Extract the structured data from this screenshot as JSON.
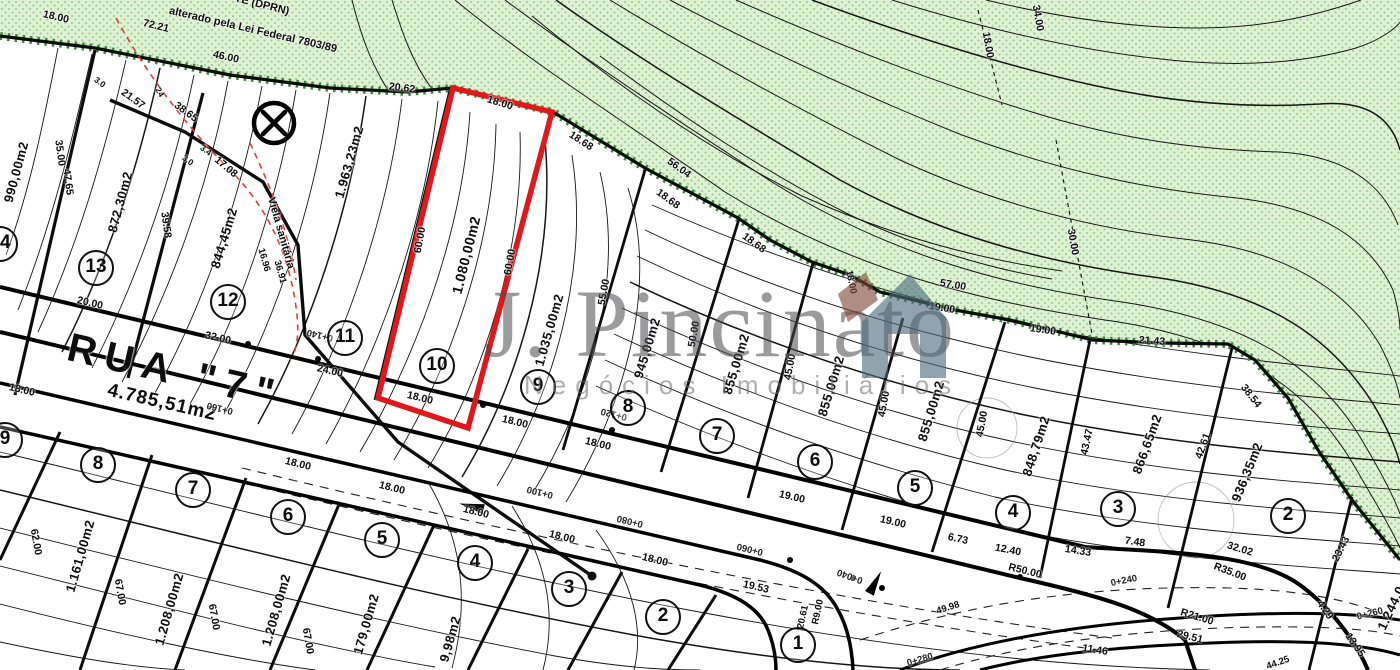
{
  "map": {
    "colors": {
      "lot_highlight_red": "#e0181c",
      "vegetation_fill": "#def1d2",
      "vegetation_dot": "#90cb90",
      "boundary_hatch_green": "#3a8a3a",
      "contour_black": "#161616",
      "red_dashed_line": "#e23b3b",
      "watermark_gray": "#48484c",
      "logo_slate": "#4e6b7e",
      "logo_brown": "#7d4a38"
    },
    "watermark": {
      "name": "J. Pincinato",
      "tagline": "Negócios Imobiliários"
    },
    "street": {
      "name": "RUA  \"7\"",
      "area": "4.785,51m2"
    },
    "highlighted_lot": {
      "number": "10",
      "area": "1.080,00m2",
      "front": "18.00",
      "depth": "60.00"
    },
    "symbols": [
      {
        "name": "circled-x-survey-marker",
        "x": 274,
        "y": 123
      }
    ],
    "badges_upper": [
      {
        "n": "14",
        "x": 0,
        "y": 244
      },
      {
        "n": "13",
        "x": 96,
        "y": 268
      },
      {
        "n": "12",
        "x": 228,
        "y": 302
      },
      {
        "n": "11",
        "x": 345,
        "y": 338
      },
      {
        "n": "10",
        "x": 437,
        "y": 366
      },
      {
        "n": "9",
        "x": 538,
        "y": 387
      },
      {
        "n": "8",
        "x": 628,
        "y": 408
      },
      {
        "n": "7",
        "x": 717,
        "y": 436
      },
      {
        "n": "6",
        "x": 815,
        "y": 462
      },
      {
        "n": "5",
        "x": 915,
        "y": 488
      },
      {
        "n": "4",
        "x": 1013,
        "y": 513
      },
      {
        "n": "3",
        "x": 1118,
        "y": 509
      },
      {
        "n": "2",
        "x": 1288,
        "y": 516
      }
    ],
    "badges_lower": [
      {
        "n": "9",
        "x": 5,
        "y": 440
      },
      {
        "n": "8",
        "x": 98,
        "y": 465
      },
      {
        "n": "7",
        "x": 193,
        "y": 490
      },
      {
        "n": "6",
        "x": 288,
        "y": 517
      },
      {
        "n": "5",
        "x": 382,
        "y": 540
      },
      {
        "n": "4",
        "x": 475,
        "y": 563
      },
      {
        "n": "3",
        "x": 569,
        "y": 589
      },
      {
        "n": "2",
        "x": 663,
        "y": 617
      },
      {
        "n": "1",
        "x": 798,
        "y": 645
      }
    ],
    "labels": [
      {
        "t": "TE (DPRN)",
        "x": 262,
        "y": 5,
        "r": 14,
        "k": "note"
      },
      {
        "t": "alterado pela Lei Federal 7803/89",
        "x": 253,
        "y": 30,
        "r": 13,
        "k": "note"
      },
      {
        "t": "Viela sanitária",
        "x": 281,
        "y": 233,
        "r": 74,
        "k": "note"
      },
      {
        "t": "RUA  \"7\"",
        "x": 175,
        "y": 372,
        "r": 13,
        "k": "street"
      },
      {
        "t": "4.785,51m2",
        "x": 162,
        "y": 403,
        "r": 13,
        "k": "street_area"
      },
      {
        "t": "990,00m2",
        "x": 16,
        "y": 172,
        "r": -75,
        "k": "area"
      },
      {
        "t": "872,30m2",
        "x": 120,
        "y": 202,
        "r": -75,
        "k": "area"
      },
      {
        "t": "844,45m2",
        "x": 224,
        "y": 238,
        "r": -73,
        "k": "area"
      },
      {
        "t": "1.963,23m2",
        "x": 349,
        "y": 162,
        "r": -74,
        "k": "area"
      },
      {
        "t": "1.080,00m2",
        "x": 466,
        "y": 255,
        "r": -76,
        "k": "area",
        "s": 14
      },
      {
        "t": "1.035,00m2",
        "x": 549,
        "y": 330,
        "r": -74,
        "k": "area"
      },
      {
        "t": "945,00m2",
        "x": 647,
        "y": 348,
        "r": -73,
        "k": "area"
      },
      {
        "t": "855,00m2",
        "x": 736,
        "y": 364,
        "r": -73,
        "k": "area"
      },
      {
        "t": "855,00m2",
        "x": 831,
        "y": 386,
        "r": -73,
        "k": "area"
      },
      {
        "t": "855,00m2",
        "x": 931,
        "y": 411,
        "r": -73,
        "k": "area"
      },
      {
        "t": "848,79m2",
        "x": 1036,
        "y": 446,
        "r": -72,
        "k": "area"
      },
      {
        "t": "866,65m2",
        "x": 1147,
        "y": 444,
        "r": -70,
        "k": "area"
      },
      {
        "t": "936,35m2",
        "x": 1247,
        "y": 472,
        "r": -68,
        "k": "area"
      },
      {
        "t": "1.244,0",
        "x": 1391,
        "y": 608,
        "r": -65,
        "k": "area"
      },
      {
        "t": "1.161,00m2",
        "x": 80,
        "y": 556,
        "r": -74,
        "k": "area"
      },
      {
        "t": "1.208,00m2",
        "x": 169,
        "y": 609,
        "r": -74,
        "k": "area"
      },
      {
        "t": "1.208,00m2",
        "x": 276,
        "y": 610,
        "r": -74,
        "k": "area"
      },
      {
        "t": "179,00m2",
        "x": 366,
        "y": 624,
        "r": -74,
        "k": "area"
      },
      {
        "t": "9,98m2",
        "x": 450,
        "y": 639,
        "r": -74,
        "k": "area"
      },
      {
        "t": "18.00",
        "x": 56,
        "y": 17,
        "r": 13,
        "k": "dim"
      },
      {
        "t": "72.21",
        "x": 156,
        "y": 26,
        "r": 14,
        "k": "dim"
      },
      {
        "t": "46.00",
        "x": 226,
        "y": 57,
        "r": 12,
        "k": "dim"
      },
      {
        "t": "20.62",
        "x": 402,
        "y": 88,
        "r": 7,
        "k": "dim"
      },
      {
        "t": "18.00",
        "x": 500,
        "y": 103,
        "r": 17,
        "k": "dim"
      },
      {
        "t": "18.68",
        "x": 581,
        "y": 141,
        "r": 33,
        "k": "dim"
      },
      {
        "t": "56.04",
        "x": 679,
        "y": 168,
        "r": 36,
        "k": "dim"
      },
      {
        "t": "18.68",
        "x": 668,
        "y": 199,
        "r": 36,
        "k": "dim"
      },
      {
        "t": "18.68",
        "x": 754,
        "y": 243,
        "r": 36,
        "k": "dim"
      },
      {
        "t": "18.00",
        "x": 851,
        "y": 282,
        "r": 78,
        "k": "dim",
        "s": 9.5
      },
      {
        "t": "57.00",
        "x": 953,
        "y": 285,
        "r": 9,
        "k": "dim"
      },
      {
        "t": "19.00",
        "x": 942,
        "y": 308,
        "r": 9,
        "k": "dim"
      },
      {
        "t": "19.00",
        "x": 1043,
        "y": 330,
        "r": 8,
        "k": "dim"
      },
      {
        "t": "21.43",
        "x": 1152,
        "y": 341,
        "r": 4,
        "k": "dim"
      },
      {
        "t": "38.54",
        "x": 1251,
        "y": 396,
        "r": 52,
        "k": "dim"
      },
      {
        "t": "18.00",
        "x": 988,
        "y": 45,
        "r": 80,
        "k": "dim"
      },
      {
        "t": "34.00",
        "x": 1038,
        "y": 18,
        "r": 80,
        "k": "dim"
      },
      {
        "t": "30.00",
        "x": 1073,
        "y": 242,
        "r": 80,
        "k": "dim"
      },
      {
        "t": "35.00",
        "x": 60,
        "y": 153,
        "r": 82,
        "k": "dim"
      },
      {
        "t": "47.65",
        "x": 68,
        "y": 182,
        "r": 82,
        "k": "dim"
      },
      {
        "t": "39.58",
        "x": 166,
        "y": 225,
        "r": 82,
        "k": "dim"
      },
      {
        "t": "21.57",
        "x": 133,
        "y": 99,
        "r": 36,
        "k": "dim"
      },
      {
        "t": "38.65",
        "x": 186,
        "y": 112,
        "r": 36,
        "k": "dim"
      },
      {
        "t": "17.08",
        "x": 226,
        "y": 167,
        "r": 40,
        "k": "dim"
      },
      {
        "t": "3.0",
        "x": 100,
        "y": 82,
        "r": 36,
        "k": "dim",
        "s": 8.5
      },
      {
        "t": "3.0",
        "x": 188,
        "y": 160,
        "r": 36,
        "k": "dim",
        "s": 8.5
      },
      {
        "t": "3.4",
        "x": 206,
        "y": 150,
        "r": 36,
        "k": "dim",
        "s": 8.5
      },
      {
        "t": "24",
        "x": 160,
        "y": 92,
        "r": 60,
        "k": "dim",
        "s": 8.5
      },
      {
        "t": "16.96",
        "x": 264,
        "y": 260,
        "r": 74,
        "k": "dim",
        "s": 9.5
      },
      {
        "t": "36.91",
        "x": 280,
        "y": 272,
        "r": 74,
        "k": "dim",
        "s": 9.5
      },
      {
        "t": "60.00",
        "x": 420,
        "y": 240,
        "r": -80,
        "k": "dim"
      },
      {
        "t": "60.00",
        "x": 510,
        "y": 262,
        "r": -80,
        "k": "dim"
      },
      {
        "t": "55.00",
        "x": 604,
        "y": 292,
        "r": -80,
        "k": "dim"
      },
      {
        "t": "50.00",
        "x": 694,
        "y": 334,
        "r": -80,
        "k": "dim"
      },
      {
        "t": "45.00",
        "x": 790,
        "y": 367,
        "r": -80,
        "k": "dim"
      },
      {
        "t": "45.00",
        "x": 884,
        "y": 404,
        "r": -80,
        "k": "dim"
      },
      {
        "t": "45.00",
        "x": 982,
        "y": 424,
        "r": -80,
        "k": "dim"
      },
      {
        "t": "43.47",
        "x": 1087,
        "y": 442,
        "r": -78,
        "k": "dim"
      },
      {
        "t": "42.61",
        "x": 1203,
        "y": 446,
        "r": -70,
        "k": "dim"
      },
      {
        "t": "23.43",
        "x": 1341,
        "y": 549,
        "r": -63,
        "k": "dim"
      },
      {
        "t": "4.29",
        "x": 1325,
        "y": 610,
        "r": 55,
        "k": "dim"
      },
      {
        "t": "13.95",
        "x": 1355,
        "y": 645,
        "r": 55,
        "k": "dim"
      },
      {
        "t": "19.00",
        "x": 792,
        "y": 497,
        "r": 13,
        "k": "dim"
      },
      {
        "t": "19.00",
        "x": 893,
        "y": 522,
        "r": 13,
        "k": "dim"
      },
      {
        "t": "6.73",
        "x": 958,
        "y": 539,
        "r": 12,
        "k": "dim"
      },
      {
        "t": "12.40",
        "x": 1008,
        "y": 550,
        "r": 11,
        "k": "dim"
      },
      {
        "t": "14.33",
        "x": 1078,
        "y": 551,
        "r": 9,
        "k": "dim"
      },
      {
        "t": "7.48",
        "x": 1135,
        "y": 542,
        "r": 8,
        "k": "dim"
      },
      {
        "t": "32.02",
        "x": 1240,
        "y": 549,
        "r": 17,
        "k": "dim"
      },
      {
        "t": "R35.00",
        "x": 1230,
        "y": 572,
        "r": 21,
        "k": "dim"
      },
      {
        "t": "R50.00",
        "x": 1025,
        "y": 571,
        "r": 14,
        "k": "dim"
      },
      {
        "t": "R21.00",
        "x": 1197,
        "y": 617,
        "r": 17,
        "k": "dim"
      },
      {
        "t": "29.51",
        "x": 1190,
        "y": 637,
        "r": 14,
        "k": "dim"
      },
      {
        "t": "11.46",
        "x": 1095,
        "y": 650,
        "r": 9,
        "k": "dim"
      },
      {
        "t": "19.53",
        "x": 756,
        "y": 587,
        "r": 13,
        "k": "dim"
      },
      {
        "t": "49.98",
        "x": 948,
        "y": 608,
        "r": -18,
        "k": "dim",
        "s": 9.5
      },
      {
        "t": "44.25",
        "x": 1278,
        "y": 663,
        "r": -20,
        "k": "dim",
        "s": 9.5
      },
      {
        "t": "R9.00",
        "x": 818,
        "y": 612,
        "r": -78,
        "k": "dim",
        "s": 9.5
      },
      {
        "t": "20.61",
        "x": 803,
        "y": 617,
        "r": -78,
        "k": "dim",
        "s": 9.5
      },
      {
        "t": "20.00",
        "x": 90,
        "y": 303,
        "r": 13,
        "k": "dim"
      },
      {
        "t": "32.00",
        "x": 218,
        "y": 338,
        "r": 13,
        "k": "dim"
      },
      {
        "t": "24.00",
        "x": 330,
        "y": 371,
        "r": 13,
        "k": "dim"
      },
      {
        "t": "18.00",
        "x": 22,
        "y": 390,
        "r": 13,
        "k": "dim"
      },
      {
        "t": "18.00",
        "x": 420,
        "y": 398,
        "r": 14,
        "k": "dim"
      },
      {
        "t": "18.00",
        "x": 515,
        "y": 422,
        "r": 14,
        "k": "dim"
      },
      {
        "t": "18.00",
        "x": 598,
        "y": 444,
        "r": 14,
        "k": "dim"
      },
      {
        "t": "18.00",
        "x": 298,
        "y": 464,
        "r": 14,
        "k": "dim"
      },
      {
        "t": "18.00",
        "x": 392,
        "y": 488,
        "r": 14,
        "k": "dim"
      },
      {
        "t": "18.00",
        "x": 476,
        "y": 512,
        "r": 14,
        "k": "dim"
      },
      {
        "t": "18.00",
        "x": 562,
        "y": 537,
        "r": 14,
        "k": "dim"
      },
      {
        "t": "18.00",
        "x": 655,
        "y": 560,
        "r": 14,
        "k": "dim"
      },
      {
        "t": "62.00",
        "x": 36,
        "y": 542,
        "r": 80,
        "k": "dim"
      },
      {
        "t": "67.00",
        "x": 120,
        "y": 592,
        "r": 80,
        "k": "dim"
      },
      {
        "t": "67.00",
        "x": 214,
        "y": 617,
        "r": 80,
        "k": "dim"
      },
      {
        "t": "67.00",
        "x": 308,
        "y": 641,
        "r": 80,
        "k": "dim"
      },
      {
        "t": "0+140",
        "x": 320,
        "y": 335,
        "r": 194,
        "k": "station"
      },
      {
        "t": "0+160",
        "x": 220,
        "y": 408,
        "r": 194,
        "k": "station"
      },
      {
        "t": "0+120",
        "x": 614,
        "y": 414,
        "r": 194,
        "k": "station"
      },
      {
        "t": "0+100",
        "x": 540,
        "y": 492,
        "r": 194,
        "k": "station"
      },
      {
        "t": "0+080",
        "x": 630,
        "y": 521,
        "r": 194,
        "k": "station"
      },
      {
        "t": "0+060",
        "x": 750,
        "y": 549,
        "r": 194,
        "k": "station"
      },
      {
        "t": "0+040",
        "x": 850,
        "y": 576,
        "r": 200,
        "k": "station"
      },
      {
        "t": "0+240",
        "x": 1124,
        "y": 581,
        "r": -11,
        "k": "station"
      },
      {
        "t": "0+260",
        "x": 1370,
        "y": 614,
        "r": -14,
        "k": "station"
      },
      {
        "t": "0+280",
        "x": 920,
        "y": 660,
        "r": -16,
        "k": "station"
      }
    ]
  }
}
